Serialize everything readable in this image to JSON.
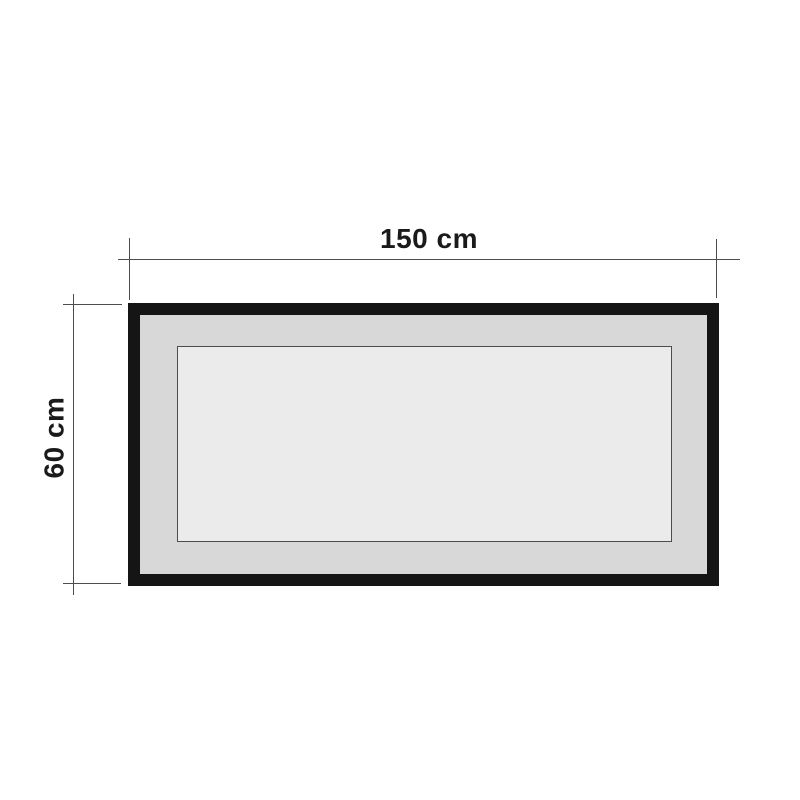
{
  "diagram": {
    "type": "product-dimension-drawing",
    "subject": "rectangular framed panel",
    "width_label": "150 cm",
    "height_label": "60 cm"
  },
  "colors": {
    "background": "#ffffff",
    "frame": "#151515",
    "mat": "#d8d8d8",
    "panel": "#ebebeb",
    "panel_outline": "#4d4d4d",
    "dimension_line": "#4d4d4d",
    "text": "#1a1a1a"
  }
}
